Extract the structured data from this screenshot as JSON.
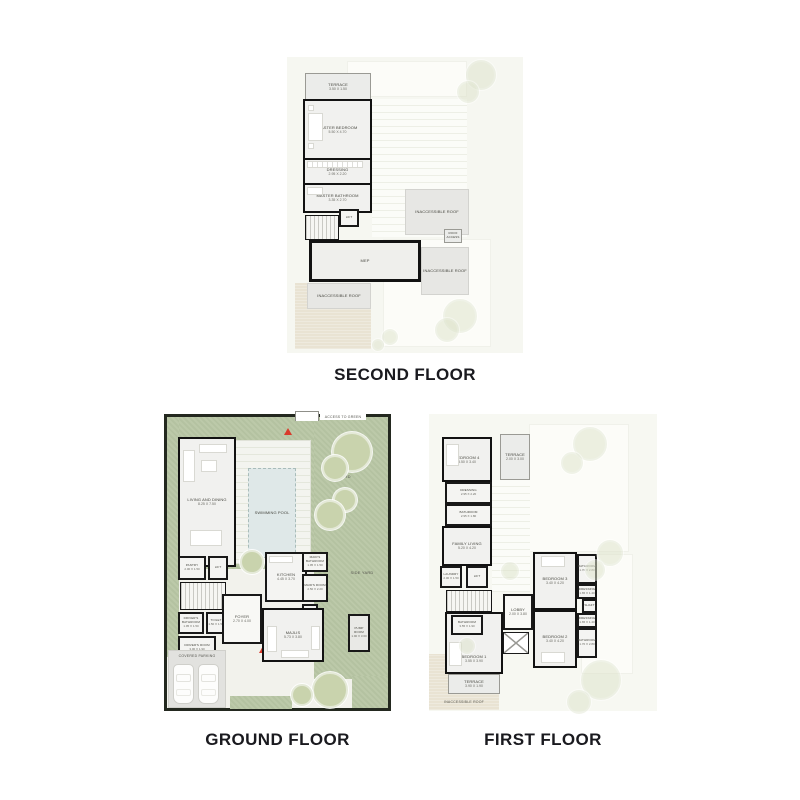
{
  "titles": {
    "second": "SECOND FLOOR",
    "ground": "GROUND FLOOR",
    "first": "FIRST FLOOR"
  },
  "colors": {
    "wall": "#181818",
    "landscape_green": "#b8c6a4",
    "tree_green": "#c9d3ad",
    "roof_gray": "#e7e7e4",
    "sand_beige": "#e9e3d3",
    "pool_blue": "#dfe8e8",
    "entry_marker_red": "#d93a2b",
    "title_text": "#1a1a1f"
  },
  "second": {
    "rooms": {
      "terrace": {
        "n": "TERRACE",
        "d": "3.50 X 1.50"
      },
      "master_bedroom": {
        "n": "MASTER BEDROOM",
        "d": "5.50 X 4.70"
      },
      "dressing": {
        "n": "DRESSING",
        "d": "2.95 X 2.20"
      },
      "master_bathroom": {
        "n": "MASTER BATHROOM",
        "d": "3.35 X 2.70"
      },
      "lift": {
        "n": "LIFT"
      },
      "mep": {
        "n": "MEP"
      },
      "roof_right_upper": {
        "n": "INACCESSIBLE ROOF"
      },
      "roof_right_lower": {
        "n": "INACCESSIBLE ROOF"
      },
      "roof_bottom_left": {
        "n": "INACCESSIBLE ROOF"
      },
      "roof_access": {
        "n": "ROOF ACCESS"
      }
    }
  },
  "ground": {
    "site": {
      "access_to_green": "ACCESS TO GREEN",
      "backyard": "BACKYARD",
      "side_yard": "SIDE YARD",
      "swimming_pool": "SWIMMING POOL",
      "covered_parking": "COVERED PARKING"
    },
    "rooms": {
      "living_dining": {
        "n": "LIVING AND DINING",
        "d": "8.25 X 7.50"
      },
      "pantry": {
        "n": "PANTRY",
        "d": "2.00 X 1.50"
      },
      "lift": {
        "n": "LIFT"
      },
      "drivers_bathroom": {
        "n": "DRIVER'S BATHROOM",
        "d": "1.95 X 1.50"
      },
      "toilet": {
        "n": "TOILET",
        "d": "1.50 X 1.50"
      },
      "drivers_room": {
        "n": "DRIVER'S ROOM",
        "d": "3.00 X 1.90"
      },
      "foyer": {
        "n": "FOYER",
        "d": "2.70 X 4.00"
      },
      "kitchen": {
        "n": "KITCHEN",
        "d": "4.45 X 3.70"
      },
      "maids_bathroom": {
        "n": "MAID'S BATHROOM",
        "d": "1.95 X 1.50"
      },
      "maids_room": {
        "n": "MAID'S ROOM",
        "d": "2.50 X 2.20"
      },
      "store": {
        "n": "STORE"
      },
      "majlis": {
        "n": "MAJLIS",
        "d": "5.73 X 3.80"
      },
      "pump_room": {
        "n": "PUMP ROOM",
        "d": "1.90 X 3.60"
      }
    }
  },
  "first": {
    "site": {
      "inaccessible_roof": "INACCESSIBLE ROOF"
    },
    "rooms": {
      "bedroom4": {
        "n": "BEDROOM 4",
        "d": "3.50 X 3.40"
      },
      "terrace_top": {
        "n": "TERRACE",
        "d": "2.00 X 3.00"
      },
      "dressing": {
        "n": "DRESSING",
        "d": "2.95 X 2.20"
      },
      "bathroom": {
        "n": "BATHROOM",
        "d": "2.95 X 1.80"
      },
      "family_living": {
        "n": "FAMILY LIVING",
        "d": "5.20 X 4.20"
      },
      "laundry": {
        "n": "LAUNDRY",
        "d": "2.00 X 1.50"
      },
      "lift": {
        "n": "LIFT"
      },
      "bathroom1": {
        "n": "BATHROOM",
        "d": "3.55 X 1.90"
      },
      "bedroom1": {
        "n": "BEDROOM 1",
        "d": "3.55 X 3.90"
      },
      "terrace_bottom": {
        "n": "TERRACE",
        "d": "3.90 X 1.90"
      },
      "lobby": {
        "n": "LOBBY",
        "d": "2.00 X 3.80"
      },
      "bedroom3": {
        "n": "BEDROOM 3",
        "d": "3.40 X 4.20"
      },
      "bathroom_r1": {
        "n": "BATHROOM",
        "d": "1.70 X 2.80"
      },
      "dressing_r1": {
        "n": "DRESSING",
        "d": "1.65 X 1.40"
      },
      "shaft": {
        "n": "SHAFT"
      },
      "dressing_r2": {
        "n": "DRESSING",
        "d": "1.65 X 1.40"
      },
      "bathroom_r2": {
        "n": "BATHROOM",
        "d": "1.70 X 2.80"
      },
      "bedroom2": {
        "n": "BEDROOM 2",
        "d": "3.40 X 4.20"
      }
    }
  }
}
